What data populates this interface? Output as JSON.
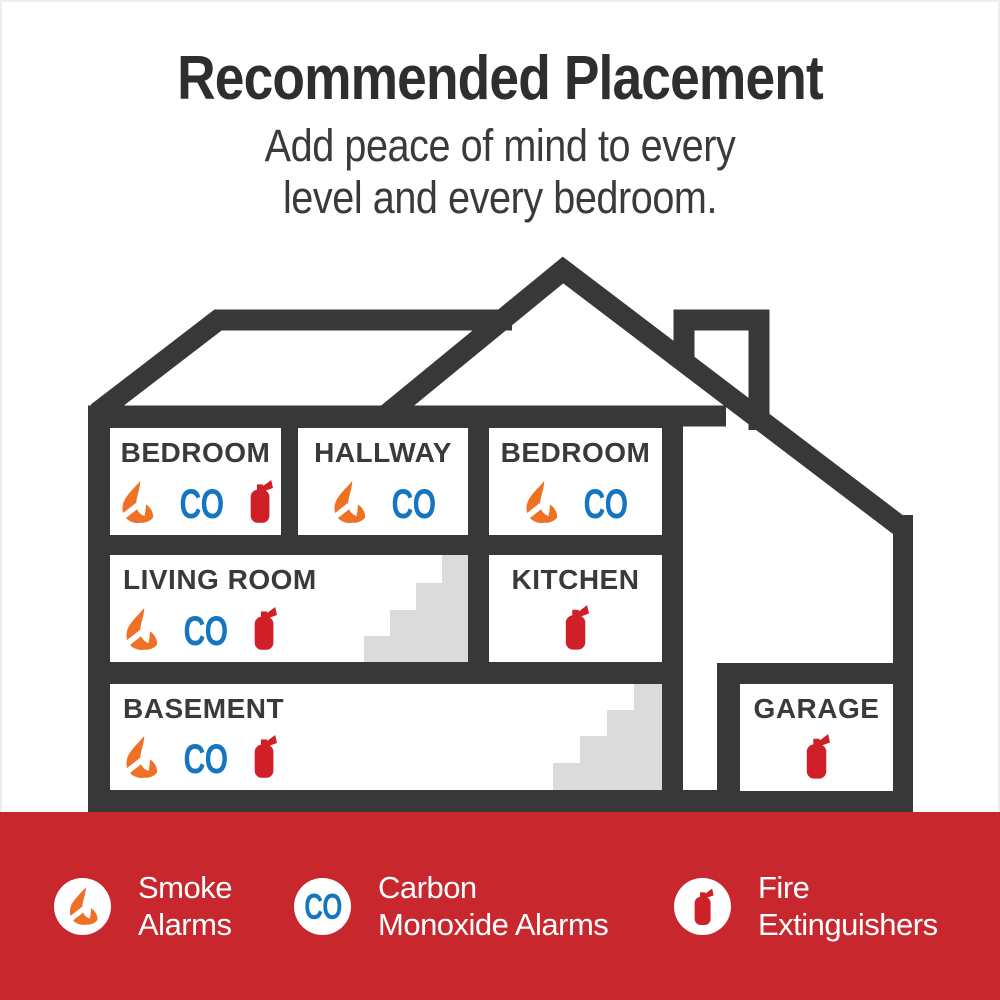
{
  "header": {
    "title": "Recommended Placement",
    "subtitle_line1": "Add peace of mind to every",
    "subtitle_line2": "level and every bedroom."
  },
  "rooms": {
    "bedroom1": {
      "label": "BEDROOM",
      "devices": [
        "smoke-alarm",
        "co-alarm",
        "fire-extinguisher"
      ]
    },
    "hallway": {
      "label": "HALLWAY",
      "devices": [
        "smoke-alarm",
        "co-alarm"
      ]
    },
    "bedroom2": {
      "label": "BEDROOM",
      "devices": [
        "smoke-alarm",
        "co-alarm"
      ]
    },
    "living_room": {
      "label": "LIVING ROOM",
      "devices": [
        "smoke-alarm",
        "co-alarm",
        "fire-extinguisher"
      ]
    },
    "kitchen": {
      "label": "KITCHEN",
      "devices": [
        "fire-extinguisher"
      ]
    },
    "basement": {
      "label": "BASEMENT",
      "devices": [
        "smoke-alarm",
        "co-alarm",
        "fire-extinguisher"
      ]
    },
    "garage": {
      "label": "GARAGE",
      "devices": [
        "fire-extinguisher"
      ]
    }
  },
  "icons": {
    "co_label": "CO"
  },
  "legend": {
    "items": [
      {
        "icon": "smoke-alarm-icon",
        "line1": "Smoke",
        "line2": "Alarms"
      },
      {
        "icon": "co-alarm-icon",
        "line1": "Carbon",
        "line2": "Monoxide Alarms"
      },
      {
        "icon": "fire-extinguisher-icon",
        "line1": "Fire",
        "line2": "Extinguishers"
      }
    ]
  },
  "colors": {
    "band_red": "#C8272E",
    "extinguisher_red": "#CE2026",
    "flame_orange": "#EE7125",
    "co_blue": "#1576BF",
    "outline_dark": "#383838",
    "stairs_gray": "#DBDBDB"
  }
}
